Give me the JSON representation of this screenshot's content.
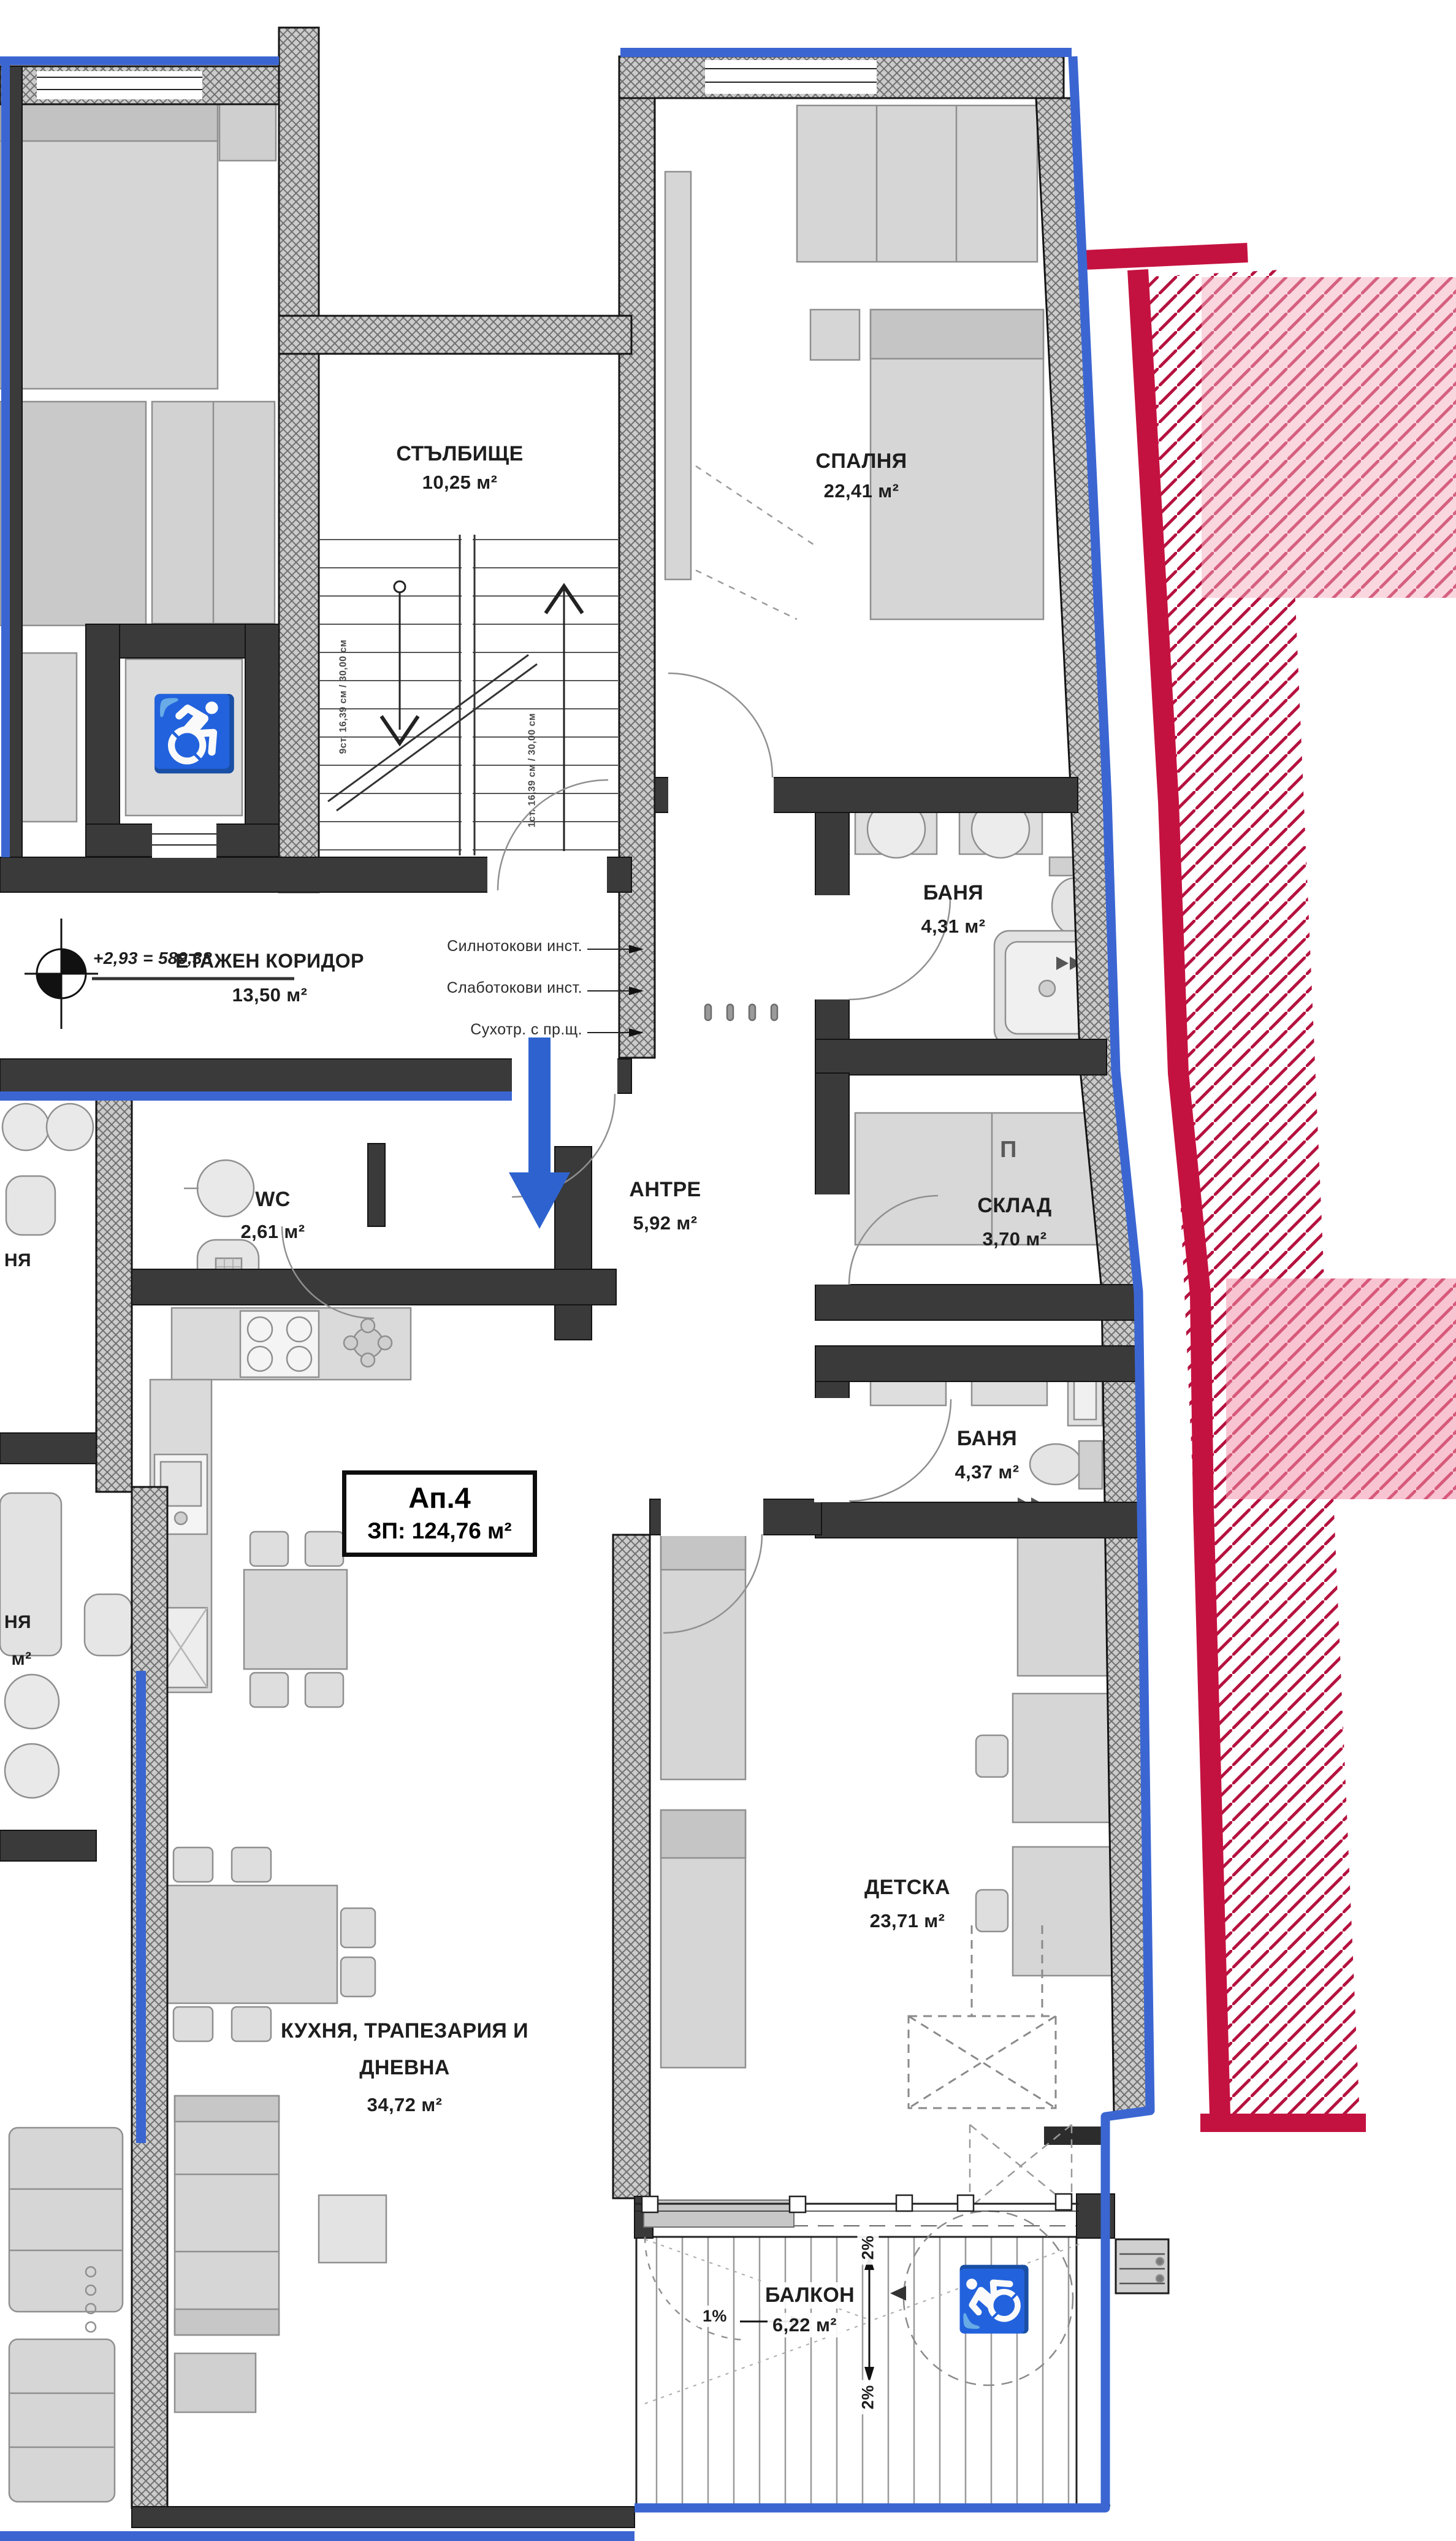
{
  "floor_plan": {
    "apartment": {
      "id": "Ап.4",
      "area": "ЗП: 124,76 м²"
    },
    "level_marker": "+2,93 = 589,38",
    "rooms": {
      "stairwell": {
        "name": "СТЪЛБИЩЕ",
        "area": "10,25 м²"
      },
      "bedroom": {
        "name": "СПАЛНЯ",
        "area": "22,41 м²"
      },
      "bath1": {
        "name": "БАНЯ",
        "area": "4,31 м²"
      },
      "corridor": {
        "name": "ЕТАЖЕН КОРИДОР",
        "area": "13,50 м²"
      },
      "wc": {
        "name": "WC",
        "area": "2,61 м²"
      },
      "hall": {
        "name": "АНТРЕ",
        "area": "5,92 м²"
      },
      "storage": {
        "name": "СКЛАД",
        "area": "3,70 м²"
      },
      "bath2": {
        "name": "БАНЯ",
        "area": "4,37 м²"
      },
      "kids": {
        "name": "ДЕТСКА",
        "area": "23,71 м²"
      },
      "kitchen": {
        "name_line1": "КУХНЯ, ТРАПЕЗАРИЯ И",
        "name_line2": "ДНЕВНА",
        "area": "34,72 м²"
      },
      "balcony": {
        "name": "БАЛКОН",
        "area": "6,22 м²"
      }
    },
    "annotations": {
      "note_power": "Силнотокови инст.",
      "note_low_current": "Слаботокови инст.",
      "note_dry_riser": "Сухотр. с пр.щ.",
      "slope_horizontal": "1%",
      "slope_vertical_top": "2%",
      "slope_vertical_bottom": "2%",
      "stair_note_left": "9ст. 16,39 см / 30,00 см",
      "stair_note_right": "1ст. 16,39 см / 30,00 см",
      "washer_symbol": "П",
      "cut_label_1": "НЯ",
      "cut_label_2": "НЯ",
      "cut_label_3": "м²",
      "wheelchair_icon": "♿"
    },
    "colors": {
      "boundary_blue": "#3b66d2",
      "accent_red": "#c41240",
      "pink_overlay": "#f5aec4"
    }
  }
}
